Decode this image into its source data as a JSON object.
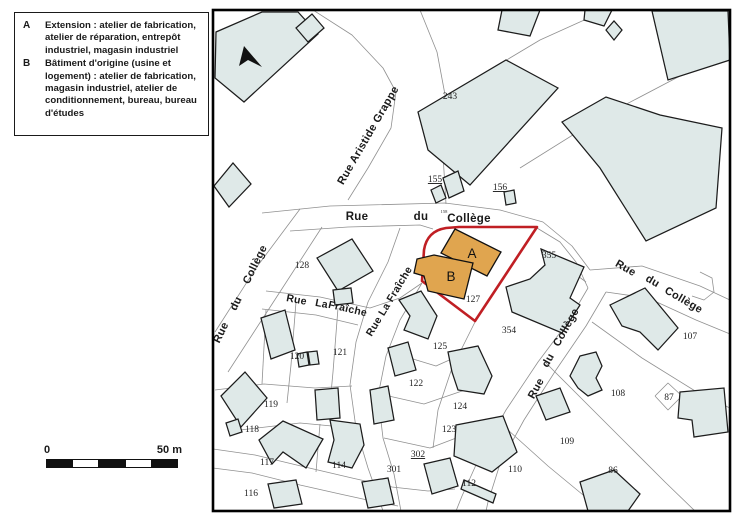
{
  "legend": {
    "items": [
      {
        "key": "A",
        "text": "Extension : atelier de fabrication, atelier de réparation, entrepôt industriel, magasin industriel"
      },
      {
        "key": "B",
        "text": "Bâtiment d'origine (usine et logement) : atelier de fabrication, magasin industriel, atelier de conditionnement, bureau, bureau d'études"
      }
    ]
  },
  "scale_bar": {
    "start_label": "0",
    "end_label": "50 m",
    "segments": 5
  },
  "map": {
    "frame": {
      "x": 213,
      "y": 10,
      "w": 517,
      "h": 501
    },
    "colors": {
      "background": "#ffffff",
      "frame_stroke": "#000000",
      "parcel_line": "#909090",
      "building_fill": "#dfe9e8",
      "building_stroke": "#1c1c1c",
      "site_outline": "#c01f24",
      "orange_fill": "#e0a54f",
      "label_color": "#1f1f1f"
    },
    "north_arrow": "244,46 262,67 248,60 239,66",
    "red_outline": "M 459,227 L 537,227 L 475,321 L 422,281 L 424,250 Q 427,231 446,228 Z",
    "parcel_lines": [
      "313,10 352,35 383,68 396,92 391,128 368,168 348,200",
      "420,10 437,52 446,100 443,155 446,204",
      "262,213 330,206 445,203 500,210 543,222",
      "290,231 348,227 420,225 433,229",
      "543,222 572,246 590,270",
      "537,228 560,242 576,262 588,288",
      "588,288 568,322 538,362 506,410 480,456 462,496 456,511",
      "606,292 586,326 556,370 524,420 500,464 488,502 486,511",
      "590,270 642,266 700,286 730,300",
      "606,292 648,298 696,320 730,334",
      "700,272 712,278 714,292 704,300 692,296",
      "300,209 256,268 215,332",
      "322,227 276,298 228,372",
      "266,291 320,297 370,308 400,298 422,283",
      "262,309 316,315 358,325",
      "400,228 388,262 368,302 356,342 350,385 356,428 368,468 380,502 383,511",
      "422,283 400,320 386,356 378,396 383,438 394,474 401,511",
      "213,449 255,455 305,467 352,478 392,487 428,491 455,489",
      "213,468 252,473 300,485 340,494 372,501 398,506",
      "475,322 452,368 438,410 433,448",
      "448,95 540,40 602,12",
      "520,168 600,118 680,76 728,58",
      "543,250 586,282",
      "592,322 642,358 700,394 730,408",
      "296,302 291,365 287,403",
      "338,308 333,372 330,404",
      "215,390 264,384 315,388 352,386",
      "262,384 266,310",
      "240,430 300,423 332,426",
      "320,424 316,472",
      "390,352 436,366 474,349",
      "380,394 424,404 465,390",
      "384,438 430,448 472,432",
      "508,430 548,466 594,504",
      "545,362 585,402 625,442 665,482 695,511",
      "655,396 668,383 682,396 668,410 655,396"
    ],
    "buildings": [
      "216,32 262,12 298,12 318,34 244,102 215,78",
      "296,28 312,14 324,28 308,42",
      "214,186 233,163 251,184 229,207",
      "418,112 506,60 558,88 470,185 428,150",
      "443,178 458,171 464,191 449,198",
      "431,190 441,185 446,198 436,203",
      "504,192 514,190 516,203 506,205",
      "606,30 614,21 622,30 614,40",
      "652,11 728,11 730,60 668,80",
      "502,10 540,10 530,36 498,30",
      "585,10 612,10 604,26 584,20",
      "562,122 606,97 660,115 722,128 716,208 646,241 600,168",
      "610,305 645,288 678,328 658,350 640,332 622,326",
      "541,249 584,267 570,298 580,305 562,333 512,312 506,287 530,279 545,265",
      "399,300 421,291 437,316 428,339 404,330 410,316",
      "317,258 352,239 373,271 338,291",
      "333,290 351,288 353,303 335,305",
      "261,318 285,310 295,350 271,359",
      "297,354 307,352 309,365 299,367",
      "308,352 317,351 319,364 310,365",
      "315,390 338,388 340,418 317,420",
      "370,390 388,386 394,420 374,424",
      "388,348 408,342 416,370 395,376",
      "221,396 245,372 267,398 241,427",
      "226,423 238,419 242,432 230,436",
      "259,440 283,421 323,439 306,468 283,452 272,464",
      "330,420 360,424 364,445 352,468 328,462 334,440",
      "448,352 478,346 492,376 484,394 458,390 452,372",
      "456,425 503,416 517,452 492,472 454,456",
      "424,464 450,458 458,486 432,494",
      "464,480 496,494 493,503 461,489",
      "362,482 388,478 394,504 368,508",
      "268,484 296,480 302,504 274,508",
      "580,356 596,352 602,366 596,378 602,390 588,396 578,388 570,376 576,364",
      "536,396 560,388 570,412 546,420",
      "680,392 724,388 728,432 694,437 692,420 678,418",
      "580,482 614,470 640,494 628,511 588,511"
    ],
    "orange_buildings": [
      {
        "label": "A",
        "points": "455,229 501,252 487,276 441,253",
        "label_x": 472,
        "label_y": 258
      },
      {
        "label": "B",
        "points": "434,255 473,263 464,299 428,291 424,276 414,273 417,259",
        "label_x": 451,
        "label_y": 281
      }
    ],
    "street_labels": [
      {
        "t": "Rue Aristide Grappe",
        "x": 371,
        "y": 137,
        "r": -60,
        "s": 11
      },
      {
        "t": "Rue",
        "x": 357,
        "y": 220,
        "r": 0,
        "s": 11.5
      },
      {
        "t": "du",
        "x": 421,
        "y": 220,
        "r": 0,
        "s": 11.5
      },
      {
        "t": "Collège",
        "x": 469,
        "y": 222,
        "r": 0,
        "s": 11.5
      },
      {
        "t": "Rue",
        "x": 224,
        "y": 334,
        "r": -64,
        "s": 11
      },
      {
        "t": "du",
        "x": 239,
        "y": 305,
        "r": -64,
        "s": 11
      },
      {
        "t": "Collège",
        "x": 258,
        "y": 266,
        "r": -64,
        "s": 11
      },
      {
        "t": "Rue",
        "x": 296,
        "y": 303,
        "r": 11,
        "s": 10.5
      },
      {
        "t": "La",
        "x": 321,
        "y": 307,
        "r": 11,
        "s": 10.5
      },
      {
        "t": "Fraîche",
        "x": 347,
        "y": 312,
        "r": 13,
        "s": 10.5
      },
      {
        "t": "Rue La Fraîche",
        "x": 392,
        "y": 303,
        "r": -59,
        "s": 10.5
      },
      {
        "t": "Rue",
        "x": 539,
        "y": 390,
        "r": -61,
        "s": 11
      },
      {
        "t": "du",
        "x": 551,
        "y": 362,
        "r": -61,
        "s": 11
      },
      {
        "t": "Collège",
        "x": 569,
        "y": 329,
        "r": -61,
        "s": 11
      },
      {
        "t": "Rue",
        "x": 624,
        "y": 271,
        "r": 30,
        "s": 11
      },
      {
        "t": "du",
        "x": 651,
        "y": 284,
        "r": 30,
        "s": 11
      },
      {
        "t": "Collège",
        "x": 682,
        "y": 303,
        "r": 30,
        "s": 11
      }
    ],
    "parcel_labels": [
      {
        "t": "243",
        "x": 450,
        "y": 99
      },
      {
        "t": "155",
        "x": 435,
        "y": 182,
        "u": true
      },
      {
        "t": "156",
        "x": 500,
        "y": 190,
        "u": true
      },
      {
        "t": "158",
        "x": 444,
        "y": 213,
        "s": 4.5
      },
      {
        "t": "128",
        "x": 302,
        "y": 268
      },
      {
        "t": "355",
        "x": 549,
        "y": 258
      },
      {
        "t": "127",
        "x": 473,
        "y": 302
      },
      {
        "t": "354",
        "x": 509,
        "y": 333
      },
      {
        "t": "120",
        "x": 297,
        "y": 359
      },
      {
        "t": "121",
        "x": 340,
        "y": 355
      },
      {
        "t": "125",
        "x": 440,
        "y": 349
      },
      {
        "t": "122",
        "x": 416,
        "y": 386
      },
      {
        "t": "124",
        "x": 460,
        "y": 409
      },
      {
        "t": "123",
        "x": 449,
        "y": 432
      },
      {
        "t": "119",
        "x": 271,
        "y": 407
      },
      {
        "t": "118",
        "x": 252,
        "y": 432
      },
      {
        "t": "117",
        "x": 267,
        "y": 465
      },
      {
        "t": "114",
        "x": 339,
        "y": 468
      },
      {
        "t": "116",
        "x": 251,
        "y": 496
      },
      {
        "t": "302",
        "x": 418,
        "y": 457,
        "u": true
      },
      {
        "t": "301",
        "x": 394,
        "y": 472
      },
      {
        "t": "112",
        "x": 469,
        "y": 486
      },
      {
        "t": "110",
        "x": 515,
        "y": 472
      },
      {
        "t": "109",
        "x": 567,
        "y": 444
      },
      {
        "t": "108",
        "x": 618,
        "y": 396
      },
      {
        "t": "87",
        "x": 669,
        "y": 400
      },
      {
        "t": "86",
        "x": 613,
        "y": 473
      },
      {
        "t": "107",
        "x": 690,
        "y": 339
      }
    ]
  }
}
